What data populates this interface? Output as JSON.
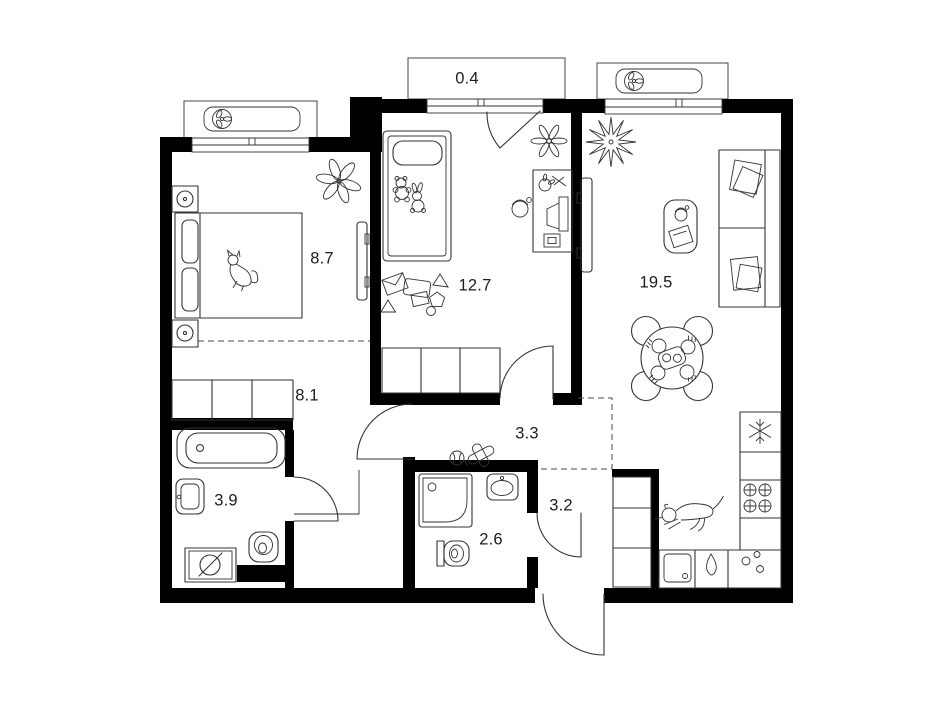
{
  "plan": {
    "rooms": [
      {
        "name": "bedroom",
        "area": "8.7"
      },
      {
        "name": "kids-room",
        "area": "12.7"
      },
      {
        "name": "living-kitchen",
        "area": "19.5"
      },
      {
        "name": "balcony",
        "area": "0.4"
      },
      {
        "name": "hall",
        "area": "8.1"
      },
      {
        "name": "corridor",
        "area": "3.3"
      },
      {
        "name": "bathroom",
        "area": "3.9"
      },
      {
        "name": "shower-room",
        "area": "2.6"
      },
      {
        "name": "entry",
        "area": "3.2"
      }
    ],
    "colors": {
      "wall": "#000000",
      "furniture_line": "#333333",
      "zone_line": "#4a4a4a",
      "label": "#1d1d1d",
      "background": "#ffffff"
    },
    "icons": [
      "air-conditioner",
      "window",
      "door-swing",
      "double-bed",
      "single-bed",
      "wardrobe",
      "bathtub",
      "sink",
      "toilet",
      "washing-machine",
      "shower-cabin",
      "fridge",
      "stove",
      "kitchen-sink",
      "dining-table",
      "sofa",
      "coffee-table",
      "tv",
      "desk",
      "computer",
      "headphones",
      "plant",
      "flower",
      "cat",
      "dog",
      "toys",
      "ball",
      "toy-plane",
      "teddy-bear",
      "bunny"
    ]
  }
}
